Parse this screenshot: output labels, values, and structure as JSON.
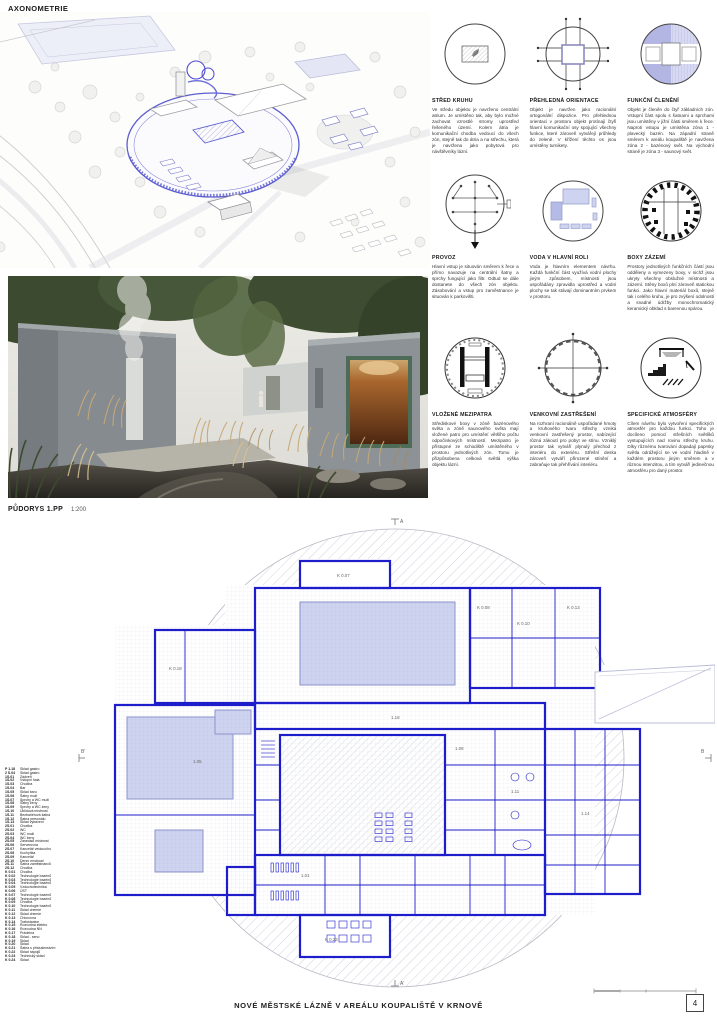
{
  "page": {
    "title": "NOVÉ MĚSTSKÉ LÁZNĚ V AREÁLU KOUPALIŠTĚ V KRNOVĚ",
    "page_number": "4"
  },
  "axonometry": {
    "label": "AXONOMETRIE"
  },
  "plan": {
    "label": "PŮDORYS 1.PP",
    "scale": "1:200",
    "section_markers": [
      "A",
      "A'",
      "B'",
      "B"
    ],
    "room_codes": [
      "K 0.07",
      "K 0.08",
      "K 0.10",
      "K 0.13",
      "1.18",
      "1.01",
      "1.05",
      "1.08",
      "1.11",
      "1.14",
      "K 0.18",
      "K 0.23"
    ]
  },
  "colors": {
    "wall_blue": "#1d1dcb",
    "pool_fill": "#ced4f0",
    "lavender_dark": "#b3b5e3",
    "lavender_light": "#d7d9f2"
  },
  "diagrams": [
    {
      "title": "STŘED KRUHU",
      "text": "Ve středu objektu je navrženo centrální atrium. Je umístěno tak, aby bylo možné zachovat vzrostlé stromy uprostřed řešeného území. Kolem átria je komunikační chodba vedoucí do všech zón, stejně tak do átria a na střechu, která je navržena jako pobytová pro návštěvníky lázní."
    },
    {
      "title": "PŘEHLEDNÁ ORIENTACE",
      "text": "Objekt je navržen jako racionální ortogonální dispozice. Pro přehlednou orientaci v prostoru objekt protínají čtyři hlavní komunikační osy spojující všechny funkce, které zároveň vytvářejí průhledy do zeleně. V křížení těchto os jsou umístěny turnikety."
    },
    {
      "title": "FUNKČNÍ ČLENĚNÍ",
      "text": "Objekt je členěn do čtyř základních zón. Vstupní část spolu s šatnami a sprchami jsou umístěny v jižní části směrem k řece. Naproti vstupu je umístěna zóna 1 - plavecký bazén. Na západní straně směrem k areálu koupaliště je navržena zóna 2 - bazénový svět. Na východní straně je zóna 3 - saunový svět."
    },
    {
      "title": "PROVOZ",
      "text": "Hlavní vstup je situován směrem k řece a přímo navazuje na centrální šatny a sprchy fungující jako filtr. Odtud se dále dostanete do všech zón objektu. Zásobování a vstup pro zaměstnance je situován k parkovišti."
    },
    {
      "title": "VODA V HLAVNÍ ROLI",
      "text": "Voda je hlavním elementem návrhu. Každá funkční část využívá vodní plochy jiným způsobem, místnosti jsou uspořádány zpravidla uprostřed a vodní plochy se tak stávají dominantním prvkem v prostoru."
    },
    {
      "title": "BOXY ZÁZEMÍ",
      "text": "Prostory jednotlivých funkčních částí jsou odděleny a vymezeny boxy, v nichž jsou ukryty všechny obslužné místnosti a zázemí. Stěny boxů plní zároveň statickou funkci. Jako hlavní materiál boxů, stejně tak i celého kruhu, je pro zvýšení odolnosti a snadné údržby monochromatický keramický obklad s barevnou spárou."
    },
    {
      "title": "VLOŽENÉ MEZIPATRA",
      "text": "Střediskové boxy v zóně bazénového světa a zóně saunového světa mají vložené patro pro umístění většího počtu odpočinkových místností. Mezipatro je přístupné ze schodiště umístěného v prostoru jednotlivých zón. Tomu je přizpůsobena celková světlá výška objektu lázní."
    },
    {
      "title": "VENKOVNÍ ZASTŘEŠENÍ",
      "text": "Na rozhraní racionálně uspořádané hmoty a kruhového tvaru střechy vzniká venkovní zastřešený prostor, nabízející různá zákoutí pro pobyt ve stínu. Vzniklý prostor tak vytváří plynulý přechod z interiéru do exteriéru. Střešní deska zároveň vytváří přirozené stínění a zabraňuje tak přehřívání interiéru."
    },
    {
      "title": "SPECIFICKÉ ATMOSFÉRY",
      "text": "Cílem návrhu bylo vytvoření specifických atmosfér pro každou funkci. Toho je docíleno pomocí střešních světlíků vystupujících nad rovinu střechy kruhu. Díky různému tvarování dopadají paprsky světla odrážející se ve vodní hladině v každém prostoru jiným směrem a v různou intenzitou, a tím vytváří jedinečnou atmosféru pro daný prostor."
    }
  ],
  "legend": {
    "entries": [
      {
        "code": "P 1.18",
        "name": "Sklad gastro"
      },
      {
        "code": "2 S.04",
        "name": "Sklad gastro"
      },
      {
        "code": "1S.01",
        "name": "Zádveří"
      },
      {
        "code": "1S.02",
        "name": "Vstupní hala"
      },
      {
        "code": "1S.03",
        "name": "Chodba"
      },
      {
        "code": "1S.04",
        "name": "Bar"
      },
      {
        "code": "1S.05",
        "name": "Sklad baru"
      },
      {
        "code": "1S.06",
        "name": "Šatny muži"
      },
      {
        "code": "1S.07",
        "name": "Sprchy a WC muži"
      },
      {
        "code": "1S.08",
        "name": "Šatny ženy"
      },
      {
        "code": "1S.09",
        "name": "Sprchy a WC ženy"
      },
      {
        "code": "1S.10",
        "name": "Úklidová místnost"
      },
      {
        "code": "1S.11",
        "name": "Bezbariérová šatna"
      },
      {
        "code": "1S.12",
        "name": "Šatna personálu"
      },
      {
        "code": "1S.13",
        "name": "Sklad vybavení"
      },
      {
        "code": "2S.01",
        "name": "Chodba"
      },
      {
        "code": "2S.02",
        "name": "WC"
      },
      {
        "code": "2S.03",
        "name": "WC muži"
      },
      {
        "code": "2S.04",
        "name": "WC ženy"
      },
      {
        "code": "2S.05",
        "name": "Zasedací místnost"
      },
      {
        "code": "2S.06",
        "name": "Serverovna"
      },
      {
        "code": "2S.07",
        "name": "Kancelář vedoucího"
      },
      {
        "code": "2S.08",
        "name": "Kuchyňka"
      },
      {
        "code": "2S.09",
        "name": "Kancelář"
      },
      {
        "code": "2S.10",
        "name": "Denní místnost"
      },
      {
        "code": "2S.11",
        "name": "Šatna zaměstnanců"
      },
      {
        "code": "2S.12",
        "name": "Chodba"
      },
      {
        "code": "K 0.01",
        "name": "Chodba"
      },
      {
        "code": "K 0.02",
        "name": "Technologie bazénů"
      },
      {
        "code": "K 0.03",
        "name": "Technologie bazénů"
      },
      {
        "code": "K 0.04",
        "name": "Technologie bazénů"
      },
      {
        "code": "K 0.05",
        "name": "Vzduchotechnika"
      },
      {
        "code": "K 0.06",
        "name": "ÚST"
      },
      {
        "code": "K 0.07",
        "name": "Technologie bazénů"
      },
      {
        "code": "K 0.08",
        "name": "Technologie bazénů"
      },
      {
        "code": "K 0.09",
        "name": "Chodba"
      },
      {
        "code": "K 0.10",
        "name": "Technologie bazénů"
      },
      {
        "code": "K 0.11",
        "name": "Sklad chemie"
      },
      {
        "code": "K 0.12",
        "name": "Sklad chemie"
      },
      {
        "code": "K 0.13",
        "name": "Chlorovna"
      },
      {
        "code": "K 0.14",
        "name": "Trafostanice"
      },
      {
        "code": "K 0.15",
        "name": "Rozvodna elektro"
      },
      {
        "code": "K 0.16",
        "name": "Rozvodna NN"
      },
      {
        "code": "K 0.17",
        "name": "Prádelna"
      },
      {
        "code": "K 0.18",
        "name": "Sklad - seno"
      },
      {
        "code": "K 0.19",
        "name": "Sklad"
      },
      {
        "code": "K 0.20",
        "name": "Sklad"
      },
      {
        "code": "K 0.21",
        "name": "Šatna s příslušenstvím"
      },
      {
        "code": "K 0.22",
        "name": "Sklad nápojů"
      },
      {
        "code": "K 0.23",
        "name": "Technický sklad"
      },
      {
        "code": "K 0.24",
        "name": "Sklad"
      }
    ]
  }
}
